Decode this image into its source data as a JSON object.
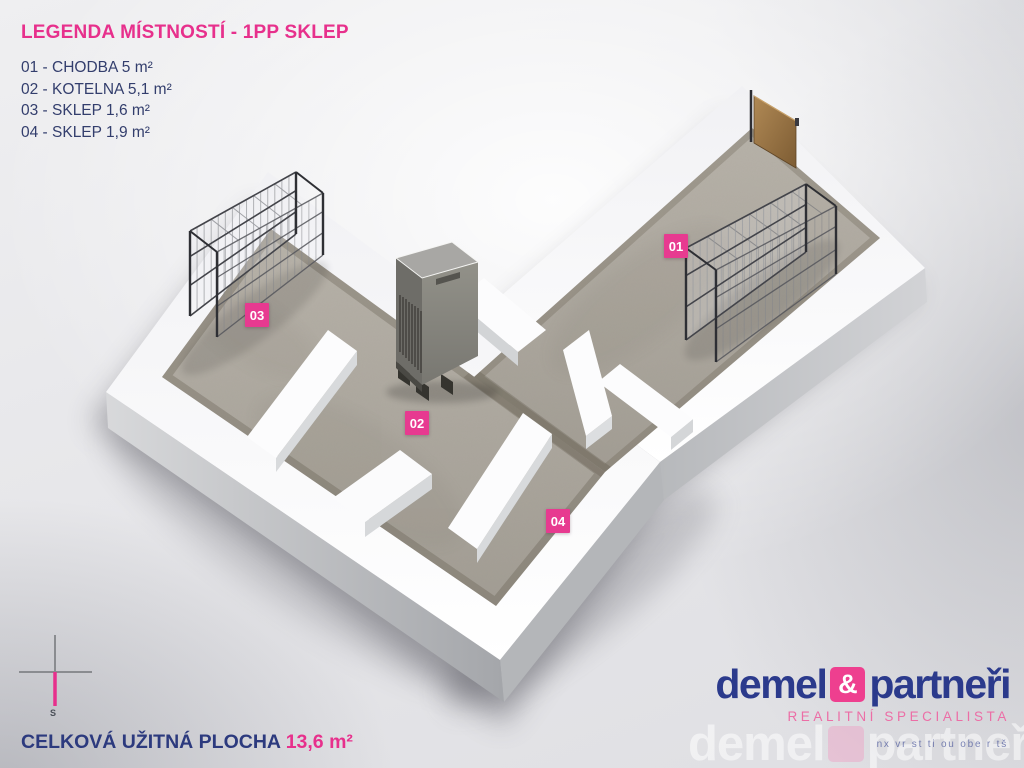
{
  "legend": {
    "title": "LEGENDA MÍSTNOSTÍ - 1PP SKLEP",
    "items": [
      "01 - CHODBA 5 m²",
      "02 - KOTELNA 5,1 m²",
      "03 - SKLEP 1,6 m²",
      "04 - SKLEP 1,9 m²"
    ]
  },
  "rooms": [
    {
      "code": "01",
      "name": "CHODBA",
      "area": "5 m²"
    },
    {
      "code": "02",
      "name": "KOTELNA",
      "area": "5,1 m²"
    },
    {
      "code": "03",
      "name": "SKLEP",
      "area": "1,6 m²"
    },
    {
      "code": "04",
      "name": "SKLEP",
      "area": "1,9 m²"
    }
  ],
  "summary": {
    "label": "CELKOVÁ UŽITNÁ PLOCHA ",
    "value": "13,6 m²"
  },
  "compass": {
    "label": "S"
  },
  "brand": {
    "word1": "demel",
    "ampersand": "&",
    "word2": "partneři",
    "subtitle": "REALITNÍ SPECIALISTA",
    "watermark_word1": "demel",
    "watermark_word2": "partneři",
    "tagline": "nx vr st ti ou obe r tš"
  },
  "colors": {
    "pink": "#e7308c",
    "badge_pink": "#e73a90",
    "navy": "#2b3a8c",
    "legend_navy": "#333e6d",
    "floor": "#aca79e",
    "wall": "#fbfbfd"
  }
}
